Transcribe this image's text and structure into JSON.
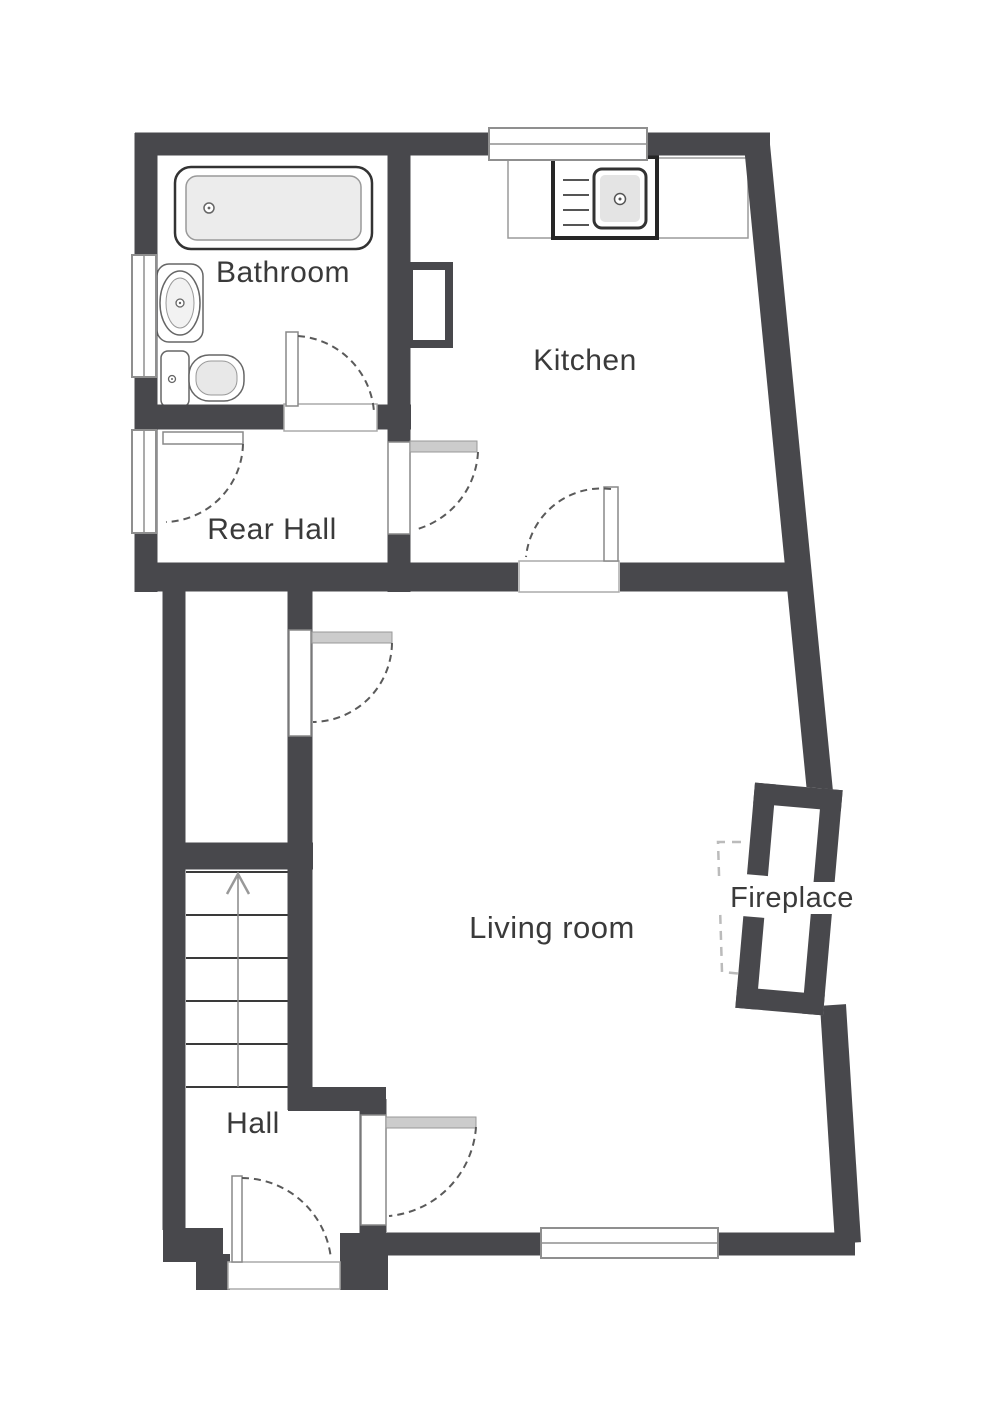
{
  "plan": {
    "type": "floorplan",
    "floor": "ground floor"
  },
  "rooms": {
    "bathroom": {
      "label": "Bathroom"
    },
    "kitchen": {
      "label": "Kitchen"
    },
    "rear_hall": {
      "label": "Rear Hall"
    },
    "living_room": {
      "label": "Living room"
    },
    "fireplace": {
      "label": "Fireplace"
    },
    "hall": {
      "label": "Hall"
    }
  },
  "fixtures": [
    "bathtub",
    "wash-basin",
    "toilet",
    "kitchen-sink-unit",
    "kitchen-counter",
    "staircase-up",
    "fireplace-chimney-breast",
    "hearth-outline",
    "window-kitchen",
    "window-bathroom",
    "window-rear-hall",
    "window-living-room",
    "door-bathroom",
    "door-rear-hall",
    "door-rear-hall-kitchen",
    "door-kitchen-living-room",
    "door-hall-living-room-upper",
    "door-hall-living-room-lower",
    "front-door"
  ],
  "stairs": {
    "direction": "up",
    "treads": 5
  },
  "colors": {
    "wall": "#48484c",
    "label": "#3a3a3a",
    "door_arc": "#5a5a5a",
    "window_border": "#8f8f8f",
    "fixture_stroke": "#555555",
    "fixture_fill": "#ececec",
    "open_door_bar": "#cccccc",
    "hearth_dash": "#bbbbbb",
    "background": "#ffffff"
  }
}
